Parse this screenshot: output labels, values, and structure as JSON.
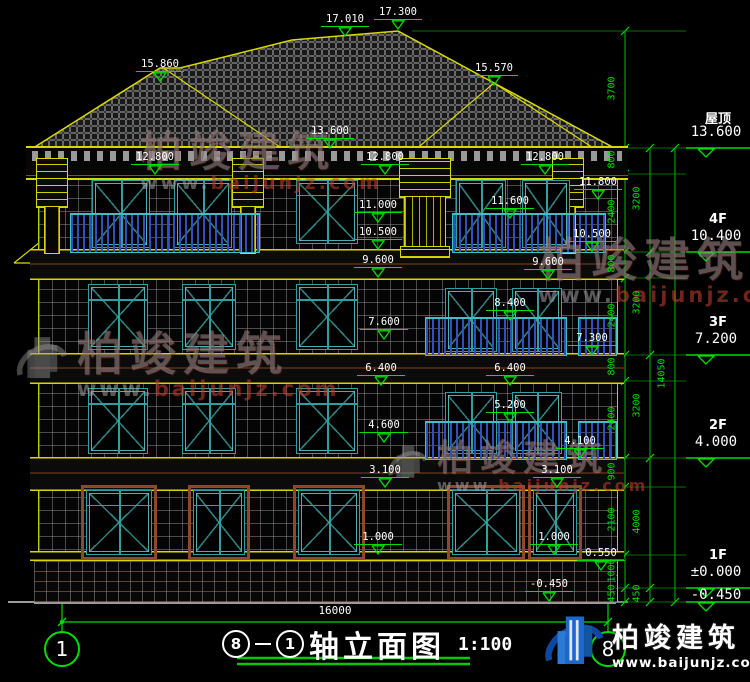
{
  "drawing_title": {
    "axis_start": "8",
    "axis_end": "1",
    "name": "轴立面图",
    "scale": "1:100"
  },
  "axis_bubbles": {
    "left": "1",
    "right": "8"
  },
  "bottom_dimension": "16000",
  "logo": {
    "brand": "柏竣建筑",
    "url": "www.baijunjz.com"
  },
  "colors": {
    "dim_green": "#00dd00",
    "cad_yellow": "#d8d800",
    "window_teal": "#2fa0a0",
    "railing_blue": "#3050c0",
    "brand_blue": "#1e68cc",
    "ground_grey": "#9a9a9a"
  },
  "elevation_markers": [
    {
      "v": "17.010",
      "cx": 345,
      "y": 13
    },
    {
      "v": "17.300",
      "cx": 398,
      "y": 6
    },
    {
      "v": "15.860",
      "cx": 160,
      "y": 58
    },
    {
      "v": "15.570",
      "cx": 494,
      "y": 62
    },
    {
      "v": "13.600",
      "cx": 330,
      "y": 125
    },
    {
      "v": "12.800",
      "cx": 155,
      "y": 151
    },
    {
      "v": "12.800",
      "cx": 385,
      "y": 151
    },
    {
      "v": "12.800",
      "cx": 545,
      "y": 151
    },
    {
      "v": "11.800",
      "cx": 598,
      "y": 176
    },
    {
      "v": "11.600",
      "cx": 510,
      "y": 195
    },
    {
      "v": "11.000",
      "cx": 378,
      "y": 199
    },
    {
      "v": "10.500",
      "cx": 378,
      "y": 226
    },
    {
      "v": "10.500",
      "cx": 592,
      "y": 228
    },
    {
      "v": "9.600",
      "cx": 378,
      "y": 254
    },
    {
      "v": "9.600",
      "cx": 548,
      "y": 256
    },
    {
      "v": "8.400",
      "cx": 510,
      "y": 297
    },
    {
      "v": "7.600",
      "cx": 384,
      "y": 316
    },
    {
      "v": "7.300",
      "cx": 592,
      "y": 332
    },
    {
      "v": "6.400",
      "cx": 381,
      "y": 362
    },
    {
      "v": "6.400",
      "cx": 510,
      "y": 362
    },
    {
      "v": "5.200",
      "cx": 510,
      "y": 399
    },
    {
      "v": "4.600",
      "cx": 384,
      "y": 419
    },
    {
      "v": "4.100",
      "cx": 580,
      "y": 435
    },
    {
      "v": "3.100",
      "cx": 385,
      "y": 464
    },
    {
      "v": "3.100",
      "cx": 557,
      "y": 464
    },
    {
      "v": "1.000",
      "cx": 378,
      "y": 531
    },
    {
      "v": "1.000",
      "cx": 554,
      "y": 531
    },
    {
      "v": "0.550",
      "cx": 601,
      "y": 547
    },
    {
      "v": "-0.450",
      "cx": 549,
      "y": 578
    }
  ],
  "right_levels": [
    {
      "name": "屋顶",
      "value": "13.600",
      "y": 148
    },
    {
      "name": "4F",
      "value": "10.400",
      "y": 252
    },
    {
      "name": "3F",
      "value": "7.200",
      "y": 355
    },
    {
      "name": "2F",
      "value": "4.000",
      "y": 458
    },
    {
      "name": "1F",
      "value": "±0.000",
      "y": 588
    },
    {
      "name": "",
      "value": "-0.450",
      "y": 602
    }
  ],
  "dim_chains": [
    {
      "x": 625,
      "boundaries": [
        31,
        148,
        174,
        252,
        278,
        355,
        381,
        458,
        487,
        555,
        588,
        602
      ],
      "segments": [
        "3700",
        "800",
        "2400",
        "800",
        "2400",
        "800",
        "2400",
        "900",
        "2100",
        "1000",
        "450"
      ]
    },
    {
      "x": 650,
      "boundaries": [
        148,
        252,
        355,
        458,
        588,
        602
      ],
      "segments": [
        "3200",
        "3200",
        "3200",
        "4000",
        "450"
      ]
    },
    {
      "x": 675,
      "boundaries": [
        148,
        602
      ],
      "segments": [
        "14050"
      ]
    }
  ],
  "extension_ys": [
    31,
    148,
    174,
    252,
    278,
    355,
    381,
    458,
    487,
    555,
    588,
    602
  ],
  "watermarks": [
    {
      "x": 140,
      "y": 130,
      "size": 42,
      "logo": false
    },
    {
      "x": 14,
      "y": 330,
      "size": 46,
      "logo": true
    },
    {
      "x": 386,
      "y": 440,
      "size": 36,
      "logo": true
    },
    {
      "x": 538,
      "y": 236,
      "size": 46,
      "logo": false
    }
  ]
}
